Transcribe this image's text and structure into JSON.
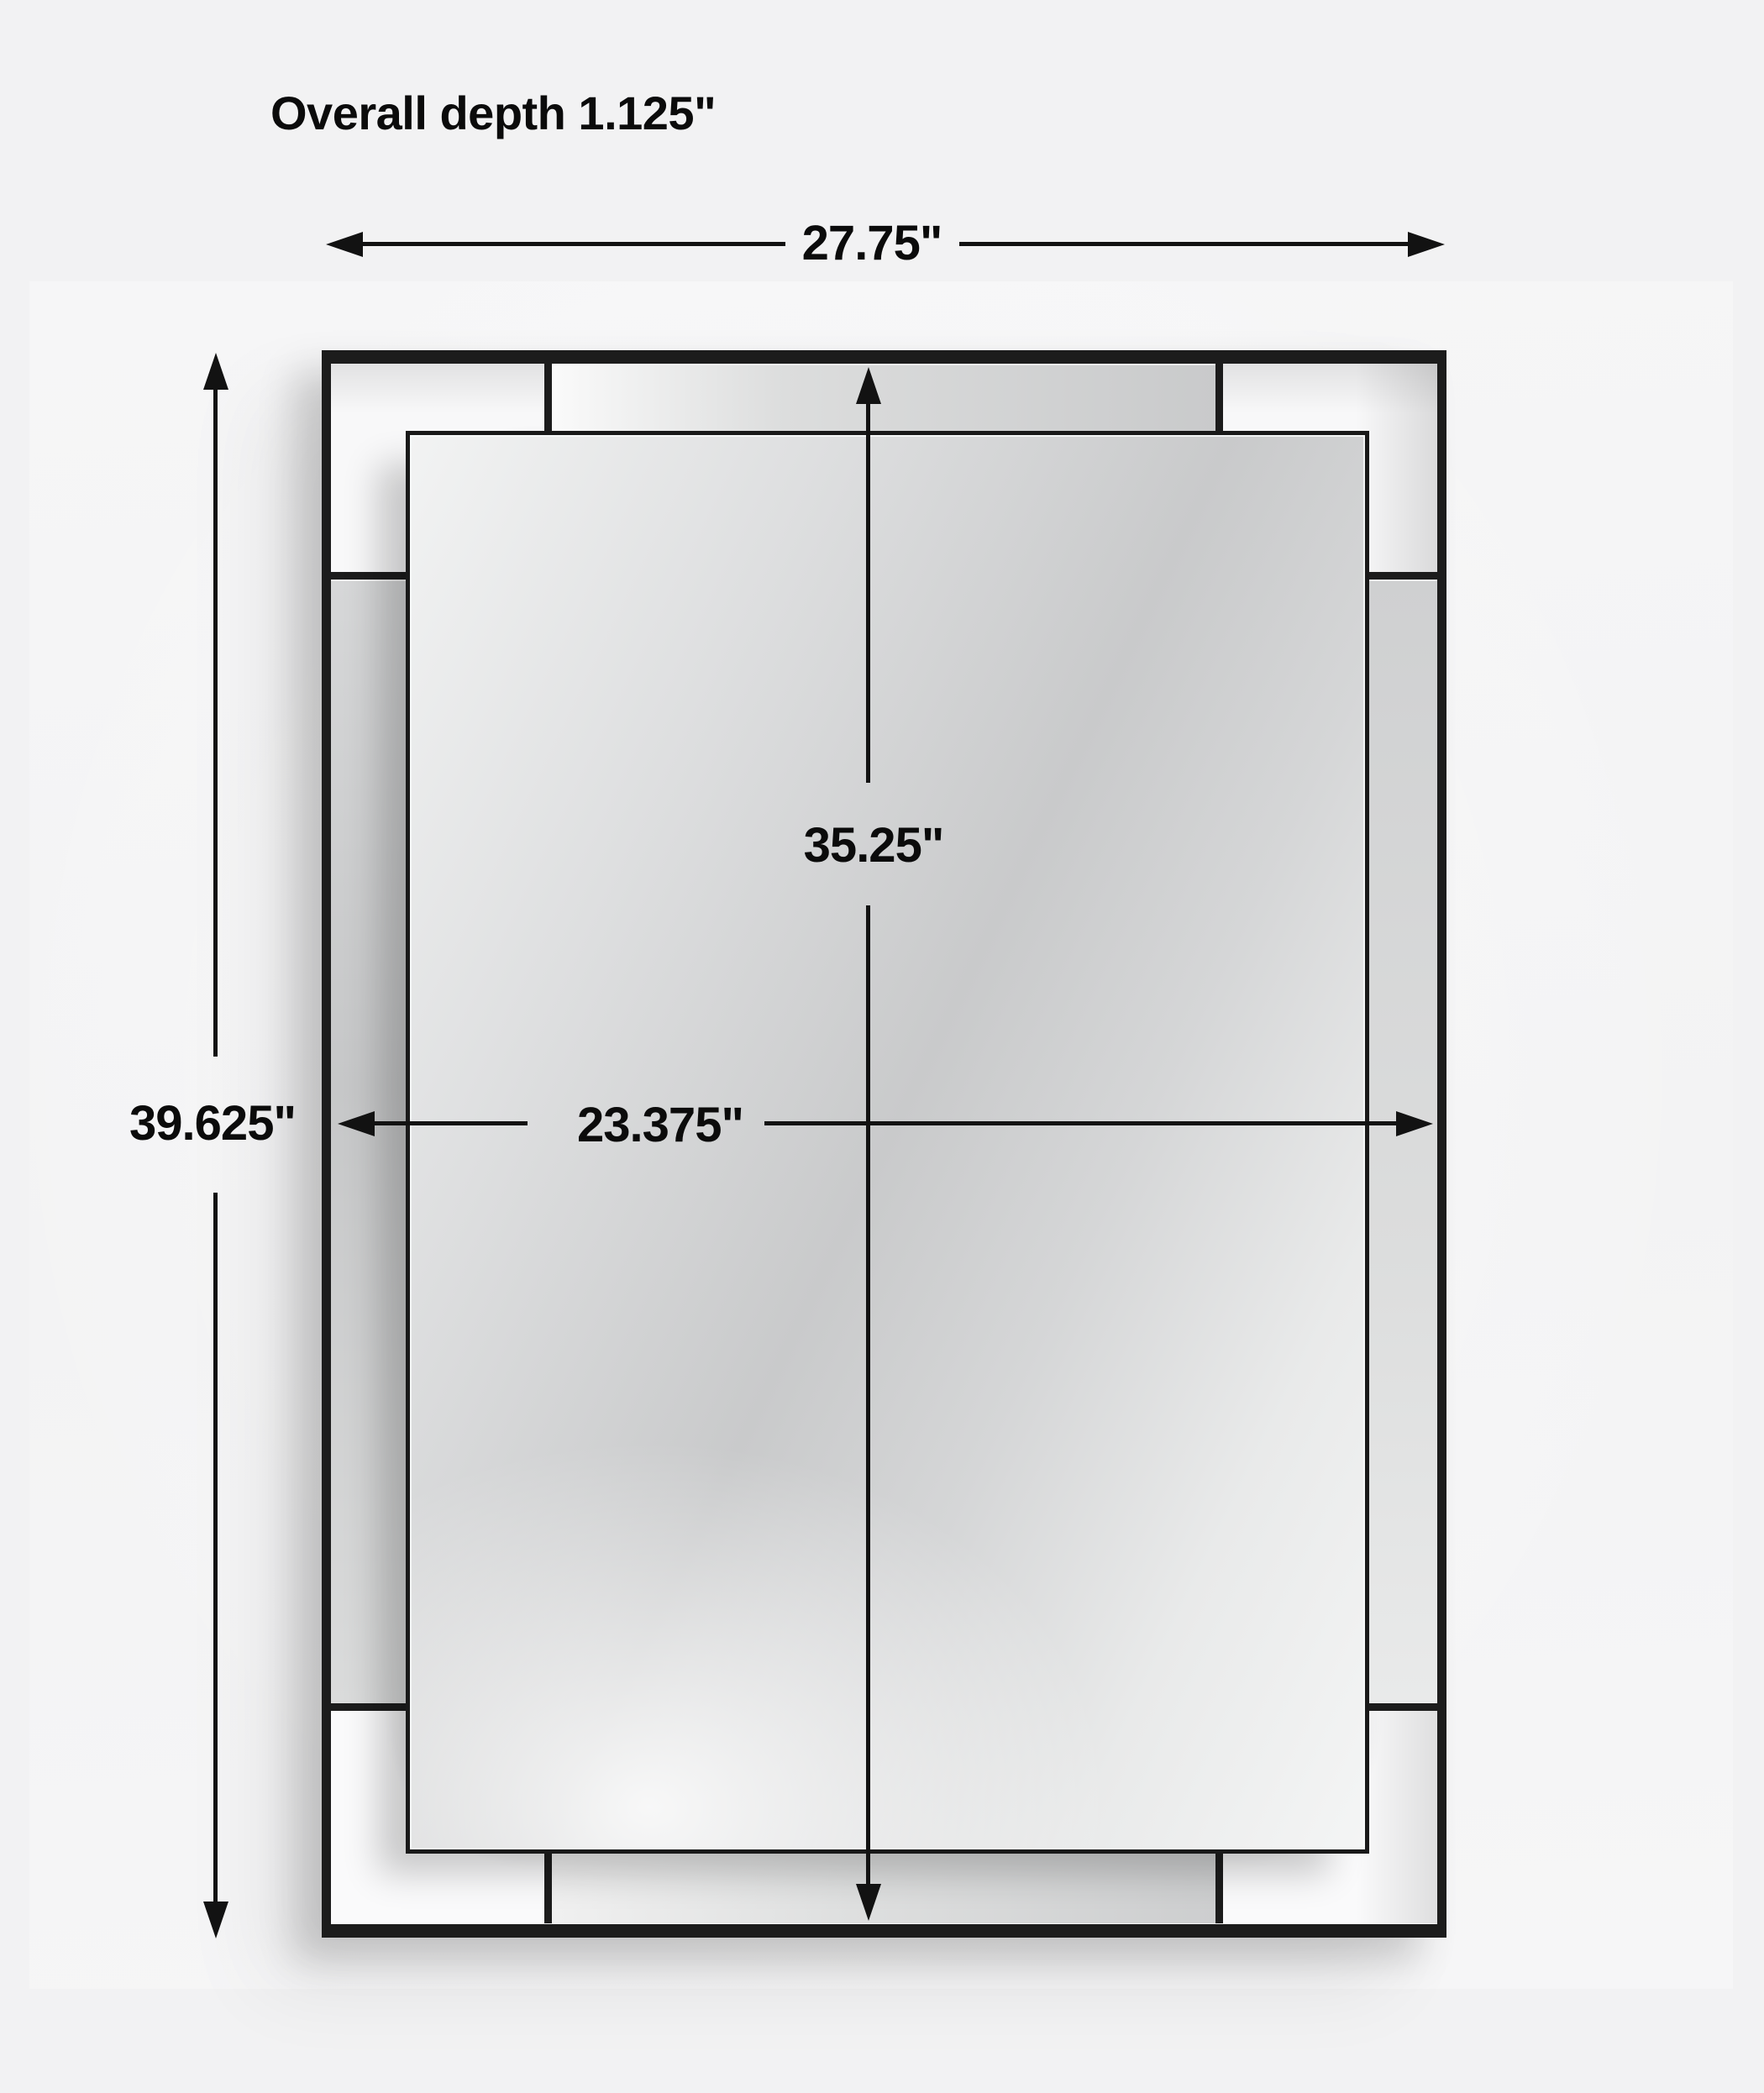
{
  "note": {
    "text": "Overall depth 1.125\""
  },
  "dims": {
    "overall_width": {
      "label": "27.75\"",
      "inches": 27.75
    },
    "overall_height": {
      "label": "39.625\"",
      "inches": 39.625
    },
    "mirror_height": {
      "label": "35.25\"",
      "inches": 35.25
    },
    "mirror_width": {
      "label": "23.375\"",
      "inches": 23.375
    }
  },
  "colors": {
    "frame_black": "#1c1c1c",
    "dimension_line": "#121212",
    "background": "#f2f2f3",
    "mirror_glass_mid": "#c9cacb"
  }
}
